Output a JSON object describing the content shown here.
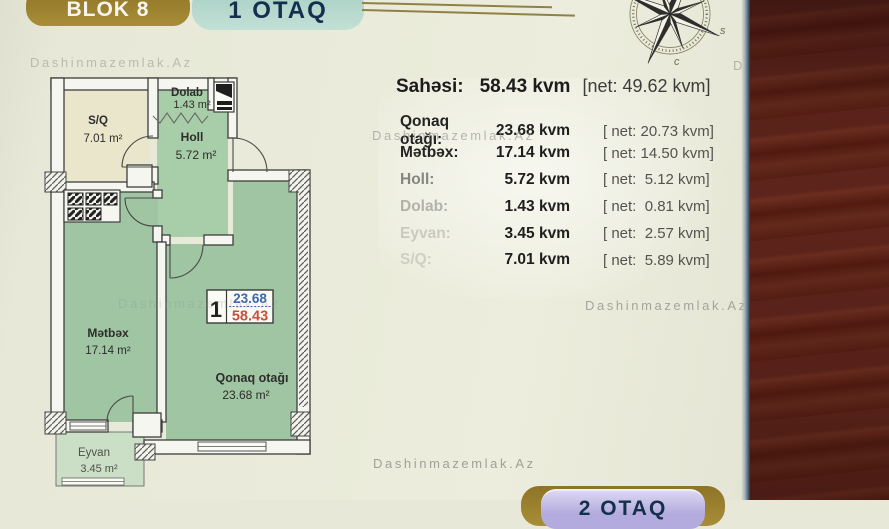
{
  "watermark_text": "Dashinmazemlak.Az",
  "header": {
    "block_badge": "BLOK 8",
    "unit_badge": "1 OTAQ"
  },
  "compass": {
    "label_s": "s",
    "label_c": "c"
  },
  "summary": {
    "label": "Sahəsi:",
    "value": "58.43 kvm",
    "net": "[net: 49.62 kvm]"
  },
  "rooms_table": {
    "rows": [
      {
        "label": "Qonaq otağı:",
        "value": "23.68 kvm",
        "net": "[ net: 20.73 kvm]"
      },
      {
        "label": "Mətbəx:",
        "value": "17.14 kvm",
        "net": "[ net: 14.50 kvm]"
      },
      {
        "label": "Holl:",
        "value": "5.72 kvm",
        "net": "[ net:  5.12 kvm]"
      },
      {
        "label": "Dolab:",
        "value": "1.43 kvm",
        "net": "[ net:  0.81 kvm]"
      },
      {
        "label": "Eyvan:",
        "value": "3.45 kvm",
        "net": "[ net:  2.57 kvm]"
      },
      {
        "label": "S/Q:",
        "value": "7.01 kvm",
        "net": "[ net:  5.89 kvm]"
      }
    ]
  },
  "floor_plan": {
    "rooms": [
      {
        "name": "S/Q",
        "area": "7.01 m²"
      },
      {
        "name": "Dolab",
        "area": "1.43 m²"
      },
      {
        "name": "Holl",
        "area": "5.72 m²"
      },
      {
        "name": "Mətbəx",
        "area": "17.14 m²"
      },
      {
        "name": "Qonaq otağı",
        "area": "23.68 m²"
      },
      {
        "name": "Eyvan",
        "area": "3.45 m²"
      }
    ],
    "unit_badge": {
      "number": "1",
      "net_area": "23.68",
      "gross_area": "58.43"
    }
  },
  "footer": {
    "next_unit_badge": "2 OTAQ"
  },
  "colors": {
    "badge_gold": "#a3862e",
    "badge_teal": "#bddbd0",
    "badge_lavender": "#b3abdd",
    "room_green": "#9fc5a2",
    "accent_blue": "#3c67ad",
    "accent_red": "#c85038",
    "wood": "#5b2119"
  }
}
